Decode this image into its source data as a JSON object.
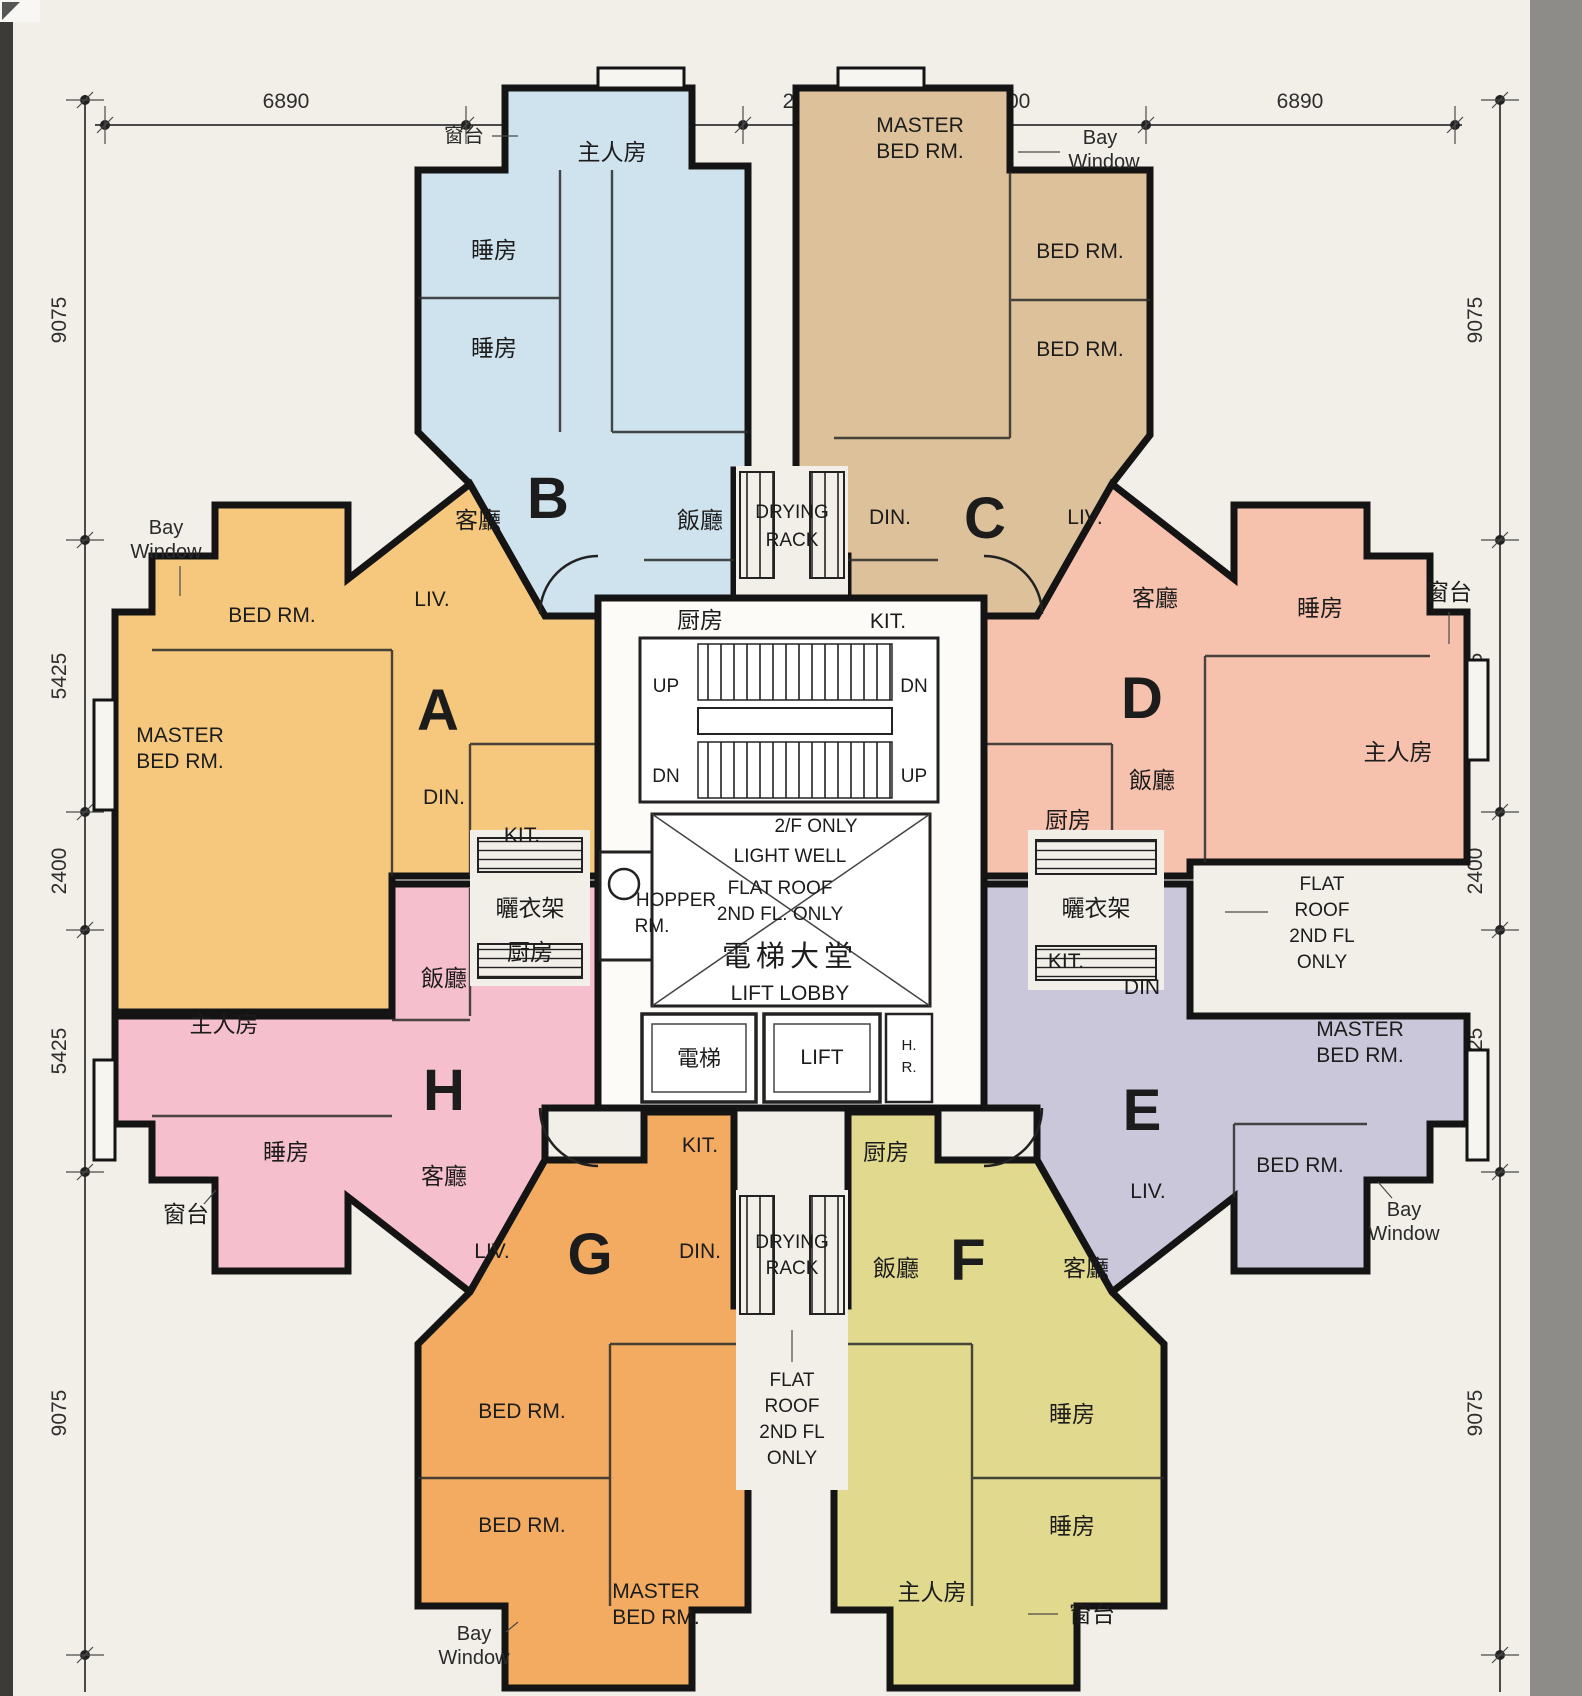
{
  "dimensions": {
    "top": [
      "6890",
      "5300",
      "2400",
      "5300",
      "6890"
    ],
    "left": [
      "9075",
      "5425",
      "2400",
      "5425",
      "9075"
    ],
    "right": [
      "9075",
      "5425",
      "2400",
      "5425",
      "9075"
    ]
  },
  "units": {
    "a": {
      "letter": "A",
      "color": "#f6c87e",
      "liv": "LIV.",
      "bed": "BED RM.",
      "master1": "MASTER",
      "master2": "BED RM.",
      "din": "DIN.",
      "kit": "KIT.",
      "bay1": "Bay",
      "bay2": "Window"
    },
    "b": {
      "letter": "B",
      "color": "#cfe3ee",
      "master": "主人房",
      "bed": "睡房",
      "liv": "客廳",
      "din": "飯廳",
      "kit": "厨房",
      "bay": "窗台"
    },
    "c": {
      "letter": "C",
      "color": "#dcc19a",
      "master1": "MASTER",
      "master2": "BED RM.",
      "bed": "BED RM.",
      "din": "DIN.",
      "liv": "LIV.",
      "kit": "KIT.",
      "bay1": "Bay",
      "bay2": "Window"
    },
    "d": {
      "letter": "D",
      "color": "#f6c2ae",
      "liv": "客廳",
      "bed": "睡房",
      "master": "主人房",
      "din": "飯廳",
      "kit": "厨房",
      "bay": "窗台"
    },
    "e": {
      "letter": "E",
      "color": "#cbc7da",
      "kit": "KIT.",
      "din": "DIN",
      "master1": "MASTER",
      "master2": "BED RM.",
      "bed": "BED RM.",
      "liv": "LIV.",
      "bay1": "Bay",
      "bay2": "Window"
    },
    "f": {
      "letter": "F",
      "color": "#e0d98e",
      "kit": "厨房",
      "din": "飯廳",
      "liv": "客廳",
      "bed": "睡房",
      "master": "主人房",
      "bay": "窗台"
    },
    "g": {
      "letter": "G",
      "color": "#f2ab60",
      "kit": "KIT.",
      "liv": "LIV.",
      "din": "DIN.",
      "bed": "BED RM.",
      "master1": "MASTER",
      "master2": "BED RM.",
      "bay1": "Bay",
      "bay2": "Window"
    },
    "h": {
      "letter": "H",
      "color": "#f5bfcd",
      "din": "飯廳",
      "kit": "厨房",
      "master": "主人房",
      "bed": "睡房",
      "liv": "客廳",
      "bay": "窗台"
    }
  },
  "core": {
    "up": "UP",
    "dn": "DN",
    "floor_note": "2/F ONLY",
    "light_well": "LIGHT WELL",
    "flat_roof1": "FLAT ROOF",
    "flat_roof2": "2ND FL. ONLY",
    "hopper1": "HOPPER",
    "hopper2": "RM.",
    "lobby_cn": "電梯大堂",
    "lobby_en": "LIFT LOBBY",
    "lift_cn": "電梯",
    "lift_en": "LIFT",
    "hr1": "H.",
    "hr2": "R."
  },
  "annotations": {
    "drying1": "DRYING",
    "drying2": "RACK",
    "drying_cn": "曬衣架",
    "fr1": "FLAT",
    "fr2": "ROOF",
    "fr3": "2ND FL",
    "fr4": "ONLY"
  }
}
